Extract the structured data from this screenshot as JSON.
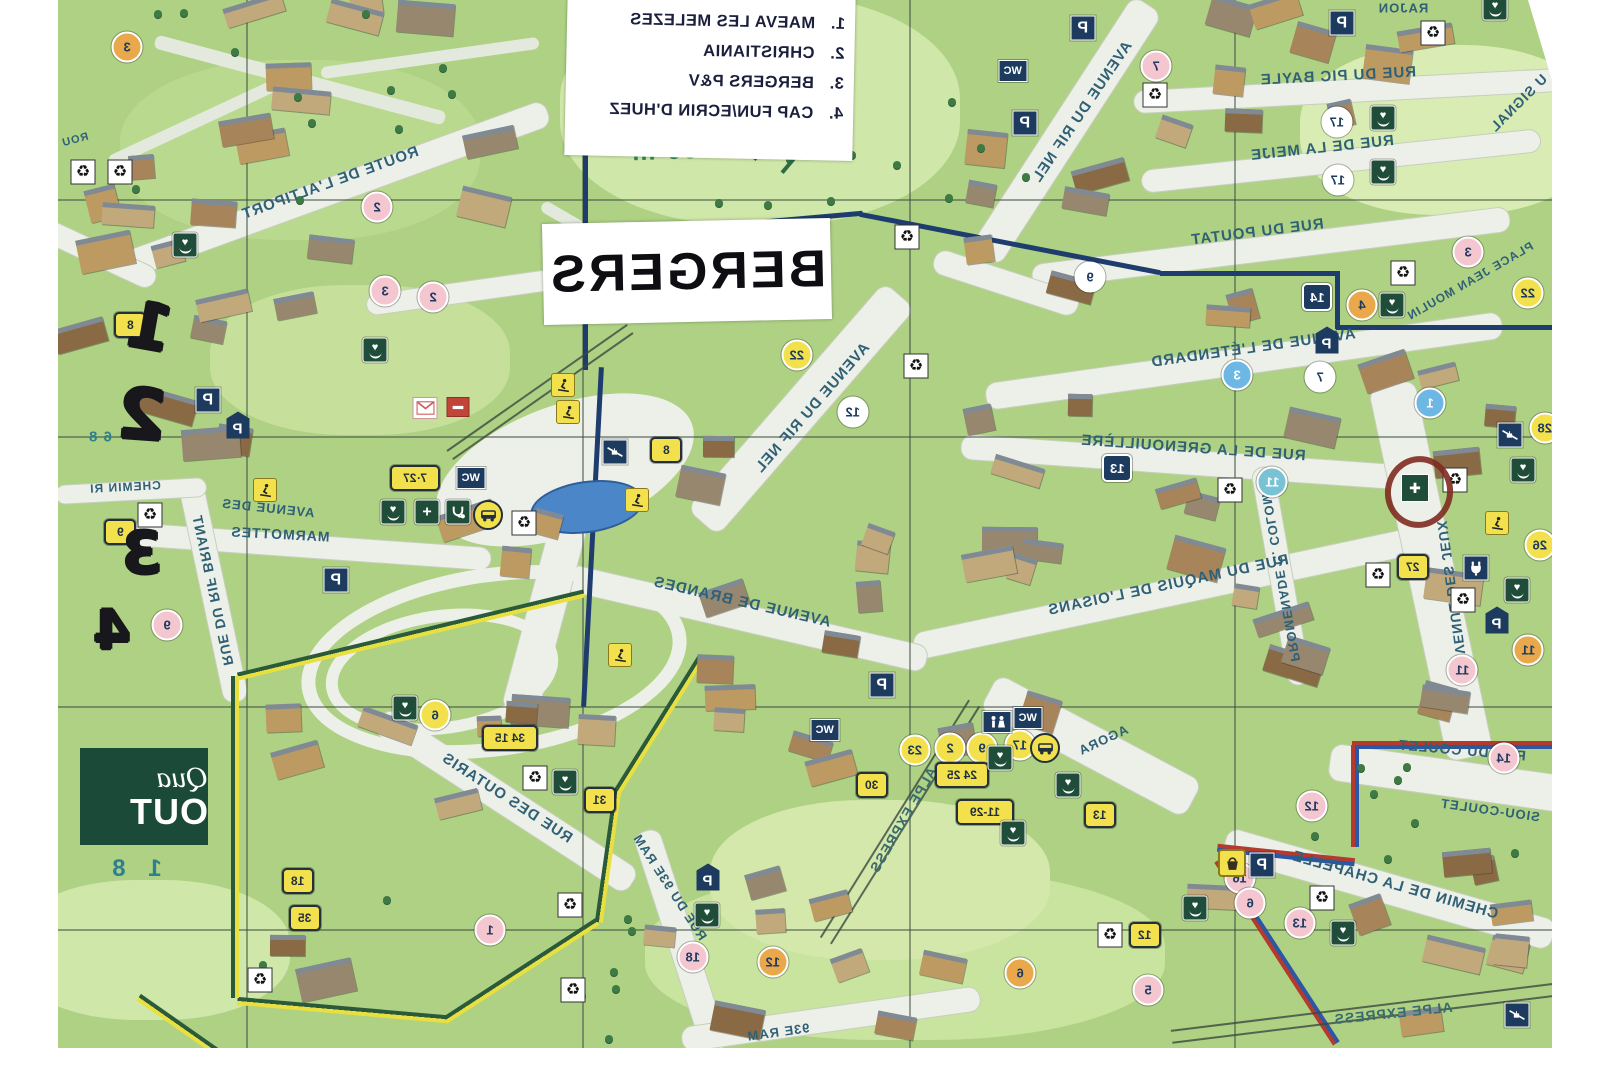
{
  "map_title": "BERGERS",
  "altitude_label": "1 860 m",
  "legend": {
    "items": [
      {
        "num": "1.",
        "name": "MAEVA LES MELEZES"
      },
      {
        "num": "2.",
        "name": "CHRISTIANIA"
      },
      {
        "num": "3.",
        "name": "BERGERS P&V"
      },
      {
        "num": "4.",
        "name": "CAP FUN/ECRIN D'HUEZ"
      }
    ]
  },
  "quartier_box": {
    "script": "Qua",
    "name": "OUT",
    "altitude_partial": "1 8"
  },
  "handwritten": [
    {
      "t": "1",
      "x": 150,
      "y": 328,
      "r": 10,
      "s": 64
    },
    {
      "t": "2",
      "x": 142,
      "y": 415,
      "r": 4,
      "s": 70
    },
    {
      "t": "3",
      "x": 142,
      "y": 553,
      "r": 0,
      "s": 58
    },
    {
      "t": "4",
      "x": 112,
      "y": 630,
      "r": 0,
      "s": 54
    }
  ],
  "streets": [
    {
      "t": "ROUTE DE L'ALTIPORT",
      "x": 330,
      "y": 183,
      "r": -20,
      "s": 15
    },
    {
      "t": "AVENUE DU RIF NEL",
      "x": 1082,
      "y": 112,
      "r": -56,
      "s": 15
    },
    {
      "t": "RUE DU PIC BAYLE",
      "x": 1338,
      "y": 76,
      "r": -3,
      "s": 15
    },
    {
      "t": "RUE DE LA MEIJE",
      "x": 1322,
      "y": 148,
      "r": -6,
      "s": 15
    },
    {
      "t": "RUE DU POUTAT",
      "x": 1257,
      "y": 232,
      "r": -7,
      "s": 15
    },
    {
      "t": "PLACE JEAN MOULIN",
      "x": 1470,
      "y": 281,
      "r": -30,
      "s": 12
    },
    {
      "t": "AVENUE DE L'ÉTENDARD",
      "x": 1253,
      "y": 348,
      "r": -8,
      "s": 15
    },
    {
      "t": "RAJON",
      "x": 1403,
      "y": 8,
      "r": 0,
      "s": 13
    },
    {
      "t": "U SIGNAL",
      "x": 1518,
      "y": 103,
      "r": -45,
      "s": 14
    },
    {
      "t": "RUE DE LA GRENOUILLÈRE",
      "x": 1193,
      "y": 448,
      "r": 4,
      "s": 15
    },
    {
      "t": "RUE DU MAQUIS DE L'OISANS",
      "x": 1168,
      "y": 585,
      "r": -12,
      "s": 15
    },
    {
      "t": "PROMENADE C. COLOMB",
      "x": 1280,
      "y": 572,
      "r": 80,
      "s": 13
    },
    {
      "t": "AVENUE DES JEUX",
      "x": 1452,
      "y": 592,
      "r": 82,
      "s": 14
    },
    {
      "t": "RUE DU COULET",
      "x": 1462,
      "y": 750,
      "r": 5,
      "s": 14
    },
    {
      "t": "SIOU-COULET",
      "x": 1490,
      "y": 810,
      "r": 8,
      "s": 13
    },
    {
      "t": "CHEMIN DE LA CHAPELLE",
      "x": 1395,
      "y": 885,
      "r": 16,
      "s": 15
    },
    {
      "t": "ALPE EXPRESS",
      "x": 1393,
      "y": 1013,
      "r": -6,
      "s": 14,
      "c": "#3a6b6e"
    },
    {
      "t": "ALPE EXPRESS",
      "x": 903,
      "y": 820,
      "r": -60,
      "s": 14,
      "c": "#3a6b6e"
    },
    {
      "t": "AVENUE DES",
      "x": 268,
      "y": 508,
      "r": 6,
      "s": 13
    },
    {
      "t": "MARMOTTES",
      "x": 280,
      "y": 534,
      "r": 3,
      "s": 14
    },
    {
      "t": "RUE DU RIF BRIANT",
      "x": 213,
      "y": 590,
      "r": 78,
      "s": 14
    },
    {
      "t": "CHEMIN RI",
      "x": 125,
      "y": 487,
      "r": -3,
      "s": 12
    },
    {
      "t": "AVENUE DE BRANDES",
      "x": 742,
      "y": 602,
      "r": 13,
      "s": 15
    },
    {
      "t": "AVENUE DU RIF NEL",
      "x": 812,
      "y": 408,
      "r": -49,
      "s": 15
    },
    {
      "t": "RUE DES OUTARIS",
      "x": 507,
      "y": 798,
      "r": 33,
      "s": 15
    },
    {
      "t": "RUE DU 93E RAM",
      "x": 670,
      "y": 887,
      "r": 57,
      "s": 13
    },
    {
      "t": "93E RAM",
      "x": 778,
      "y": 1032,
      "r": -8,
      "s": 13
    },
    {
      "t": "AGORA",
      "x": 1103,
      "y": 740,
      "r": -25,
      "s": 13
    },
    {
      "t": "ROU",
      "x": 75,
      "y": 140,
      "r": -15,
      "s": 11
    },
    {
      "t": "6 8",
      "x": 100,
      "y": 437,
      "r": 0,
      "s": 15,
      "c": "#2e7f8f"
    }
  ],
  "markers": [
    {
      "k": "pink",
      "t": "2",
      "x": 377,
      "y": 207
    },
    {
      "k": "pink",
      "t": "3",
      "x": 385,
      "y": 291
    },
    {
      "k": "pink",
      "t": "2",
      "x": 433,
      "y": 297
    },
    {
      "k": "pink",
      "t": "7",
      "x": 1156,
      "y": 66
    },
    {
      "k": "pink",
      "t": "3",
      "x": 1468,
      "y": 252
    },
    {
      "k": "pink",
      "t": "9",
      "x": 167,
      "y": 625
    },
    {
      "k": "pink",
      "t": "14",
      "x": 1504,
      "y": 758
    },
    {
      "k": "pink",
      "t": "12",
      "x": 1312,
      "y": 806
    },
    {
      "k": "pink",
      "t": "16",
      "x": 1240,
      "y": 878
    },
    {
      "k": "pink",
      "t": "13",
      "x": 1300,
      "y": 923
    },
    {
      "k": "pink",
      "t": "18",
      "x": 693,
      "y": 957
    },
    {
      "k": "pink",
      "t": "5",
      "x": 1148,
      "y": 990
    },
    {
      "k": "pink",
      "t": "6",
      "x": 1250,
      "y": 903
    },
    {
      "k": "pink",
      "t": "11",
      "x": 1462,
      "y": 670
    },
    {
      "k": "pink",
      "t": "1",
      "x": 490,
      "y": 930
    },
    {
      "k": "orange",
      "t": "3",
      "x": 127,
      "y": 47
    },
    {
      "k": "orange",
      "t": "4",
      "x": 1362,
      "y": 305
    },
    {
      "k": "orange",
      "t": "12",
      "x": 773,
      "y": 962
    },
    {
      "k": "orange",
      "t": "6",
      "x": 1020,
      "y": 973
    },
    {
      "k": "orange",
      "t": "11",
      "x": 1528,
      "y": 650
    },
    {
      "k": "blue",
      "t": "1",
      "x": 1430,
      "y": 403
    },
    {
      "k": "blue",
      "t": "3",
      "x": 1237,
      "y": 375
    },
    {
      "k": "teal",
      "t": "11",
      "x": 1272,
      "y": 482
    },
    {
      "k": "navysq",
      "t": "14",
      "x": 1317,
      "y": 297
    },
    {
      "k": "navysq",
      "t": "13",
      "x": 1117,
      "y": 468
    },
    {
      "k": "white",
      "t": "17",
      "x": 1337,
      "y": 122
    },
    {
      "k": "white",
      "t": "17",
      "x": 1338,
      "y": 180
    },
    {
      "k": "white",
      "t": "9",
      "x": 1090,
      "y": 277
    },
    {
      "k": "white",
      "t": "12",
      "x": 853,
      "y": 412
    },
    {
      "k": "white",
      "t": "7",
      "x": 1320,
      "y": 377
    },
    {
      "k": "ycirc",
      "t": "22",
      "x": 797,
      "y": 355
    },
    {
      "k": "ycirc",
      "t": "22",
      "x": 1528,
      "y": 293
    },
    {
      "k": "ycirc",
      "t": "26",
      "x": 1540,
      "y": 545
    },
    {
      "k": "ycirc",
      "t": "28",
      "x": 1545,
      "y": 428
    },
    {
      "k": "ycirc",
      "t": "2",
      "x": 950,
      "y": 748
    },
    {
      "k": "ycirc",
      "t": "9",
      "x": 982,
      "y": 748
    },
    {
      "k": "ycirc",
      "t": "6",
      "x": 435,
      "y": 715
    },
    {
      "k": "ycirc",
      "t": "17",
      "x": 1020,
      "y": 745
    },
    {
      "k": "ycirc",
      "t": "23",
      "x": 915,
      "y": 750
    },
    {
      "k": "ybadge",
      "t": "8",
      "x": 130,
      "y": 325
    },
    {
      "k": "ybadge",
      "t": "9",
      "x": 120,
      "y": 532
    },
    {
      "k": "ybadge",
      "t": "8",
      "x": 666,
      "y": 450
    },
    {
      "k": "ybadge",
      "t": "7·27",
      "x": 415,
      "y": 478,
      "w": 46
    },
    {
      "k": "ybadge",
      "t": "27",
      "x": 1413,
      "y": 567
    },
    {
      "k": "ybadge",
      "t": "34 15",
      "x": 510,
      "y": 738,
      "w": 52
    },
    {
      "k": "ybadge",
      "t": "31",
      "x": 600,
      "y": 800
    },
    {
      "k": "ybadge",
      "t": "18",
      "x": 298,
      "y": 881
    },
    {
      "k": "ybadge",
      "t": "35",
      "x": 305,
      "y": 918
    },
    {
      "k": "ybadge",
      "t": "30",
      "x": 872,
      "y": 785
    },
    {
      "k": "ybadge",
      "t": "24 25",
      "x": 962,
      "y": 775,
      "w": 50
    },
    {
      "k": "ybadge",
      "t": "11-29",
      "x": 985,
      "y": 812,
      "w": 54
    },
    {
      "k": "ybadge",
      "t": "13",
      "x": 1100,
      "y": 815
    },
    {
      "k": "ybadge",
      "t": "12",
      "x": 1145,
      "y": 935
    }
  ],
  "icons": [
    {
      "k": "p",
      "x": 208,
      "y": 400
    },
    {
      "k": "p",
      "x": 1025,
      "y": 123
    },
    {
      "k": "p",
      "x": 1083,
      "y": 28
    },
    {
      "k": "p",
      "x": 1342,
      "y": 23
    },
    {
      "k": "p",
      "x": 882,
      "y": 685
    },
    {
      "k": "p",
      "x": 1262,
      "y": 865
    },
    {
      "k": "p",
      "x": 336,
      "y": 580
    },
    {
      "k": "ph",
      "x": 238,
      "y": 425
    },
    {
      "k": "ph",
      "x": 1327,
      "y": 340
    },
    {
      "k": "ph",
      "x": 708,
      "y": 877
    },
    {
      "k": "ph",
      "x": 1497,
      "y": 620
    },
    {
      "k": "wc",
      "x": 1013,
      "y": 71
    },
    {
      "k": "wc",
      "x": 471,
      "y": 478
    },
    {
      "k": "wc",
      "x": 825,
      "y": 730
    },
    {
      "k": "wc",
      "x": 1028,
      "y": 718
    },
    {
      "k": "wcfig",
      "x": 997,
      "y": 722
    },
    {
      "k": "rec",
      "x": 83,
      "y": 172
    },
    {
      "k": "rec",
      "x": 120,
      "y": 172
    },
    {
      "k": "rec",
      "x": 150,
      "y": 515
    },
    {
      "k": "rec",
      "x": 524,
      "y": 523
    },
    {
      "k": "rec",
      "x": 535,
      "y": 778
    },
    {
      "k": "rec",
      "x": 570,
      "y": 905
    },
    {
      "k": "rec",
      "x": 260,
      "y": 980
    },
    {
      "k": "rec",
      "x": 916,
      "y": 366
    },
    {
      "k": "rec",
      "x": 1155,
      "y": 95
    },
    {
      "k": "rec",
      "x": 907,
      "y": 237
    },
    {
      "k": "rec",
      "x": 1230,
      "y": 490
    },
    {
      "k": "rec",
      "x": 1403,
      "y": 273
    },
    {
      "k": "rec",
      "x": 1455,
      "y": 480
    },
    {
      "k": "rec",
      "x": 1463,
      "y": 600
    },
    {
      "k": "rec",
      "x": 1322,
      "y": 898
    },
    {
      "k": "rec",
      "x": 1110,
      "y": 935
    },
    {
      "k": "rec",
      "x": 1433,
      "y": 33
    },
    {
      "k": "rec",
      "x": 1378,
      "y": 575
    },
    {
      "k": "rec",
      "x": 573,
      "y": 990
    },
    {
      "k": "heart",
      "x": 185,
      "y": 245
    },
    {
      "k": "heart",
      "x": 375,
      "y": 350
    },
    {
      "k": "heart",
      "x": 1392,
      "y": 305
    },
    {
      "k": "heart",
      "x": 1523,
      "y": 470
    },
    {
      "k": "heart",
      "x": 1517,
      "y": 590
    },
    {
      "k": "heart",
      "x": 405,
      "y": 708
    },
    {
      "k": "heart",
      "x": 565,
      "y": 782
    },
    {
      "k": "heart",
      "x": 1000,
      "y": 758
    },
    {
      "k": "heart",
      "x": 1068,
      "y": 785
    },
    {
      "k": "heart",
      "x": 1013,
      "y": 833
    },
    {
      "k": "heart",
      "x": 707,
      "y": 915
    },
    {
      "k": "heart",
      "x": 1195,
      "y": 908
    },
    {
      "k": "heart",
      "x": 1343,
      "y": 933
    },
    {
      "k": "heart",
      "x": 1383,
      "y": 118
    },
    {
      "k": "heart",
      "x": 1383,
      "y": 172
    },
    {
      "k": "heart",
      "x": 1495,
      "y": 8
    },
    {
      "k": "heart",
      "x": 393,
      "y": 512
    },
    {
      "k": "med",
      "x": 427,
      "y": 512
    },
    {
      "k": "steth",
      "x": 458,
      "y": 512
    },
    {
      "k": "bus",
      "x": 488,
      "y": 515
    },
    {
      "k": "bus",
      "x": 1045,
      "y": 748
    },
    {
      "k": "mail",
      "x": 425,
      "y": 408
    },
    {
      "k": "mail2",
      "x": 458,
      "y": 407
    },
    {
      "k": "lift",
      "x": 615,
      "y": 452
    },
    {
      "k": "lift",
      "x": 1510,
      "y": 435
    },
    {
      "k": "lift",
      "x": 1517,
      "y": 1015
    },
    {
      "k": "plug",
      "x": 1476,
      "y": 568
    },
    {
      "k": "basket",
      "x": 1232,
      "y": 863
    },
    {
      "k": "target",
      "x": 1415,
      "y": 488
    },
    {
      "k": "ski",
      "x": 563,
      "y": 385
    },
    {
      "k": "ski",
      "x": 568,
      "y": 412
    },
    {
      "k": "ski",
      "x": 637,
      "y": 500
    },
    {
      "k": "ski",
      "x": 1497,
      "y": 523
    },
    {
      "k": "ski",
      "x": 265,
      "y": 490
    },
    {
      "k": "ski",
      "x": 620,
      "y": 655
    }
  ],
  "icon_names": {
    "p": "parking-icon",
    "ph": "parking-house-icon",
    "wc": "wc-icon",
    "wcfig": "wc-figures-icon",
    "rec": "recycle-icon",
    "heart": "heart-label-icon",
    "med": "medical-icon",
    "steth": "stethoscope-icon",
    "bus": "bus-icon",
    "mail": "mail-icon",
    "mail2": "mail-red-icon",
    "lift": "skilift-icon",
    "plug": "plug-icon",
    "basket": "basket-icon",
    "target": "target-marker-icon",
    "ski": "skier-icon"
  },
  "palette": {
    "pink": "#f3c6d0",
    "orange": "#e9a84c",
    "yellow": "#f2e14c",
    "white": "#ffffff",
    "blue": "#6cb7e4",
    "teal": "#79c2d4",
    "navy": "#1d3a5f",
    "street_text": "#2f6076",
    "map_green": "#aed184",
    "boundary_navy": "#1e3c6e",
    "boundary_yellow": "#e8e040",
    "boundary_green": "#2a5a3a",
    "boundary_red": "#b23b2e",
    "boundary_blue": "#2b57a5"
  }
}
